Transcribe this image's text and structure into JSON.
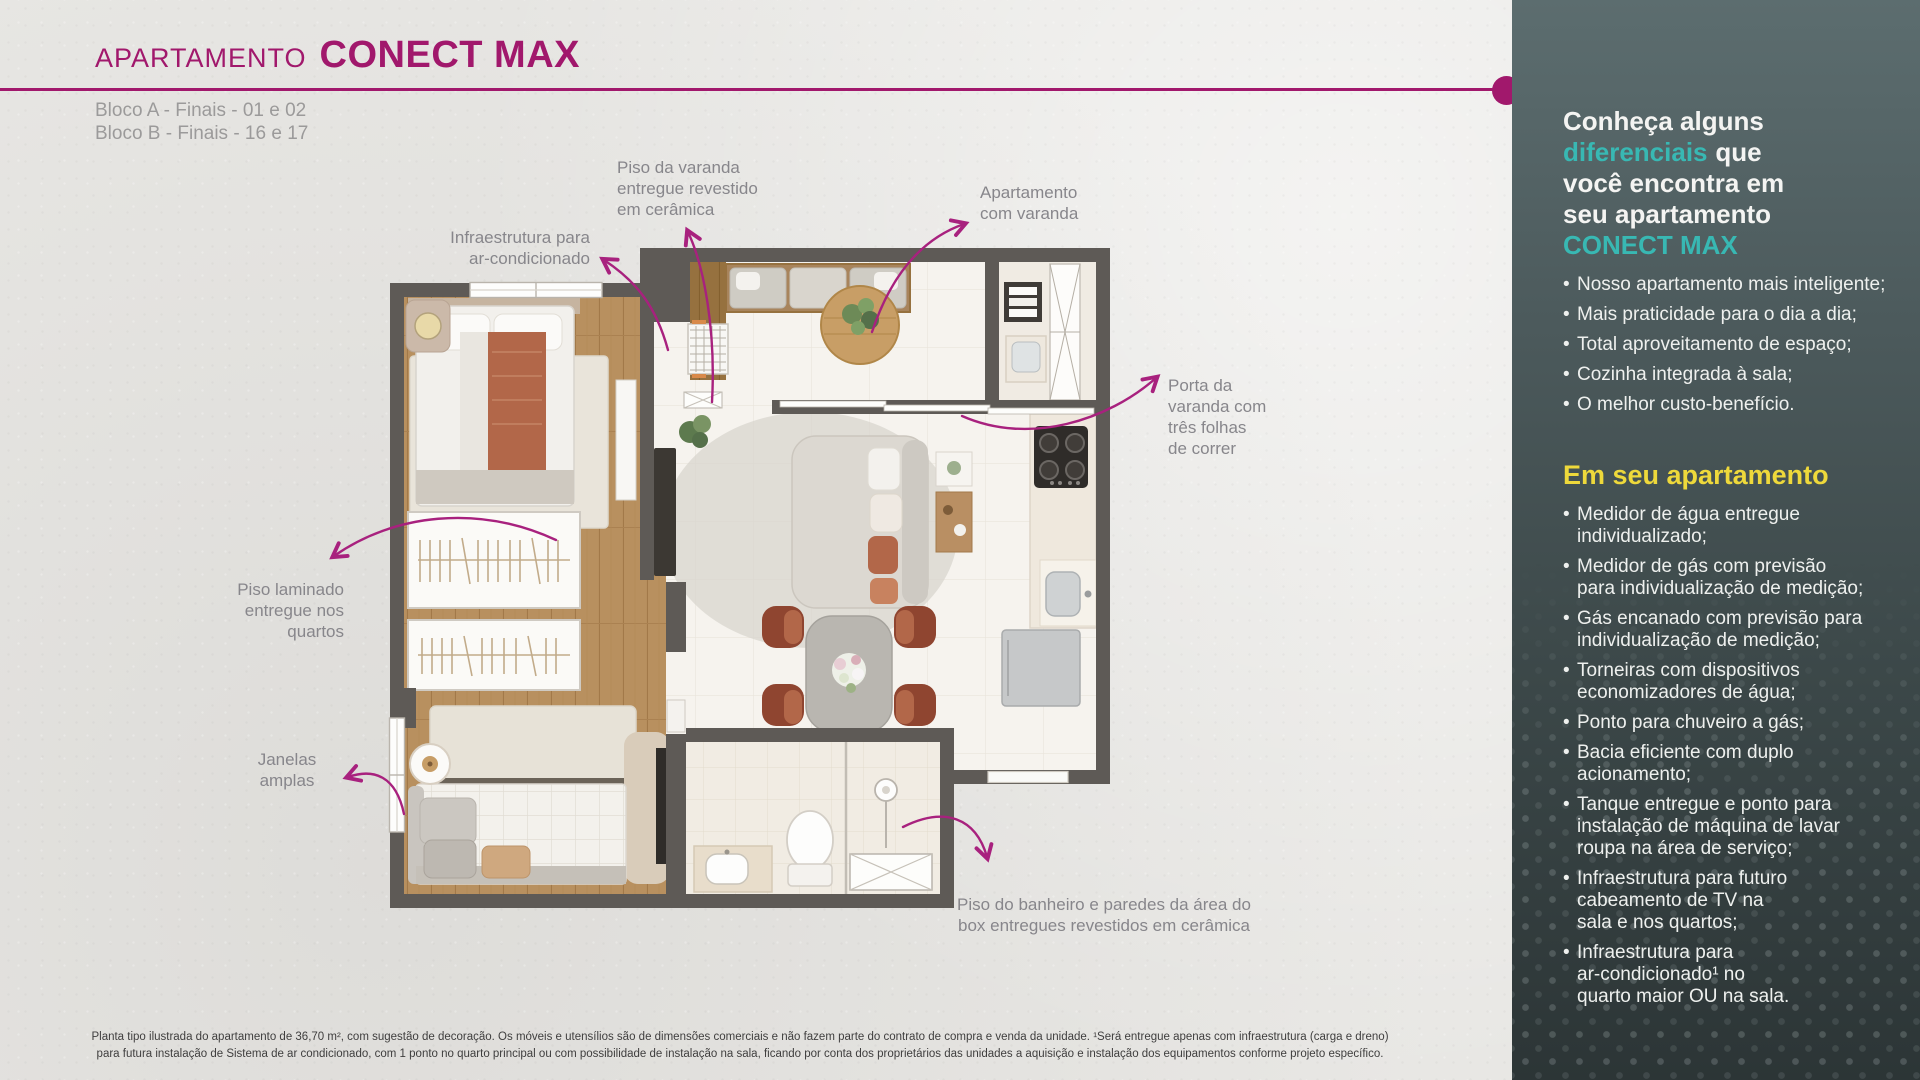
{
  "header": {
    "kicker": "APARTAMENTO",
    "name": "CONECT MAX",
    "blocks": "Bloco A - Finais - 01 e 02\nBloco B - Finais - 16 e 17"
  },
  "plan": {
    "callouts": {
      "piso_varanda": "Piso da varanda\nentregue revestido\nem cerâmica",
      "apartamento_varanda": "Apartamento\ncom varanda",
      "infraestrutura_ac": "Infraestrutura para\nar-condicionado",
      "porta_varanda": "Porta da\nvaranda com\ntrês folhas\nde correr",
      "piso_laminado": "Piso laminado\nentregue nos\nquartos",
      "janelas_amplas": "Janelas\namplas",
      "piso_banheiro": "Piso do banheiro e paredes da área do\nbox entregues revestidos em cerâmica"
    }
  },
  "sidebar": {
    "intro": {
      "line1": "Conheça alguns",
      "highlight": "diferenciais",
      "line2_rest": "que",
      "line3": "você encontra em",
      "line4": "seu apartamento",
      "brand": "CONECT MAX"
    },
    "bullets": [
      "Nosso apartamento mais inteligente;",
      "Mais praticidade para o dia a dia;",
      "Total aproveitamento de espaço;",
      "Cozinha integrada à sala;",
      "O melhor custo-benefício."
    ],
    "section2": {
      "title": "Em seu apartamento",
      "bullets": [
        "Medidor de água entregue\nindividualizado;",
        "Medidor de gás com previsão\npara individualização de medição;",
        "Gás encanado com previsão para\nindividualização de medição;",
        "Torneiras com dispositivos\neconomizadores de água;",
        "Ponto para chuveiro a gás;",
        "Bacia eficiente com duplo\nacionamento;",
        "Tanque entregue e ponto para\ninstalação de máquina de lavar\nroupa na área de serviço;",
        "Infraestrutura para futuro\ncabeamento de TV na\nsala e nos quartos;",
        "Infraestrutura para\nar-condicionado¹ no\nquarto maior OU na sala."
      ]
    }
  },
  "footer": {
    "disclaimer": "Planta tipo ilustrada do apartamento de 36,70 m², com sugestão de decoração. Os móveis e utensílios são de dimensões comerciais e não fazem parte do contrato de compra e venda da unidade.  ¹Será entregue apenas com infraestrutura (carga e dreno)\npara futura instalação de Sistema de ar condicionado, com 1 ponto no quarto principal ou com possibilidade de instalação na sala, ficando por conta dos proprietários das unidades a aquisição e instalação dos equipamentos conforme projeto específico."
  },
  "colors": {
    "magenta": "#a1186c",
    "teal": "#38b8b3",
    "yellow": "#eed93b",
    "panel_top": "#5c6d6f",
    "panel_bottom": "#2c3536",
    "wall_gray": "#5e5a56",
    "wood": "#b8905f",
    "label_gray": "#87868b"
  }
}
